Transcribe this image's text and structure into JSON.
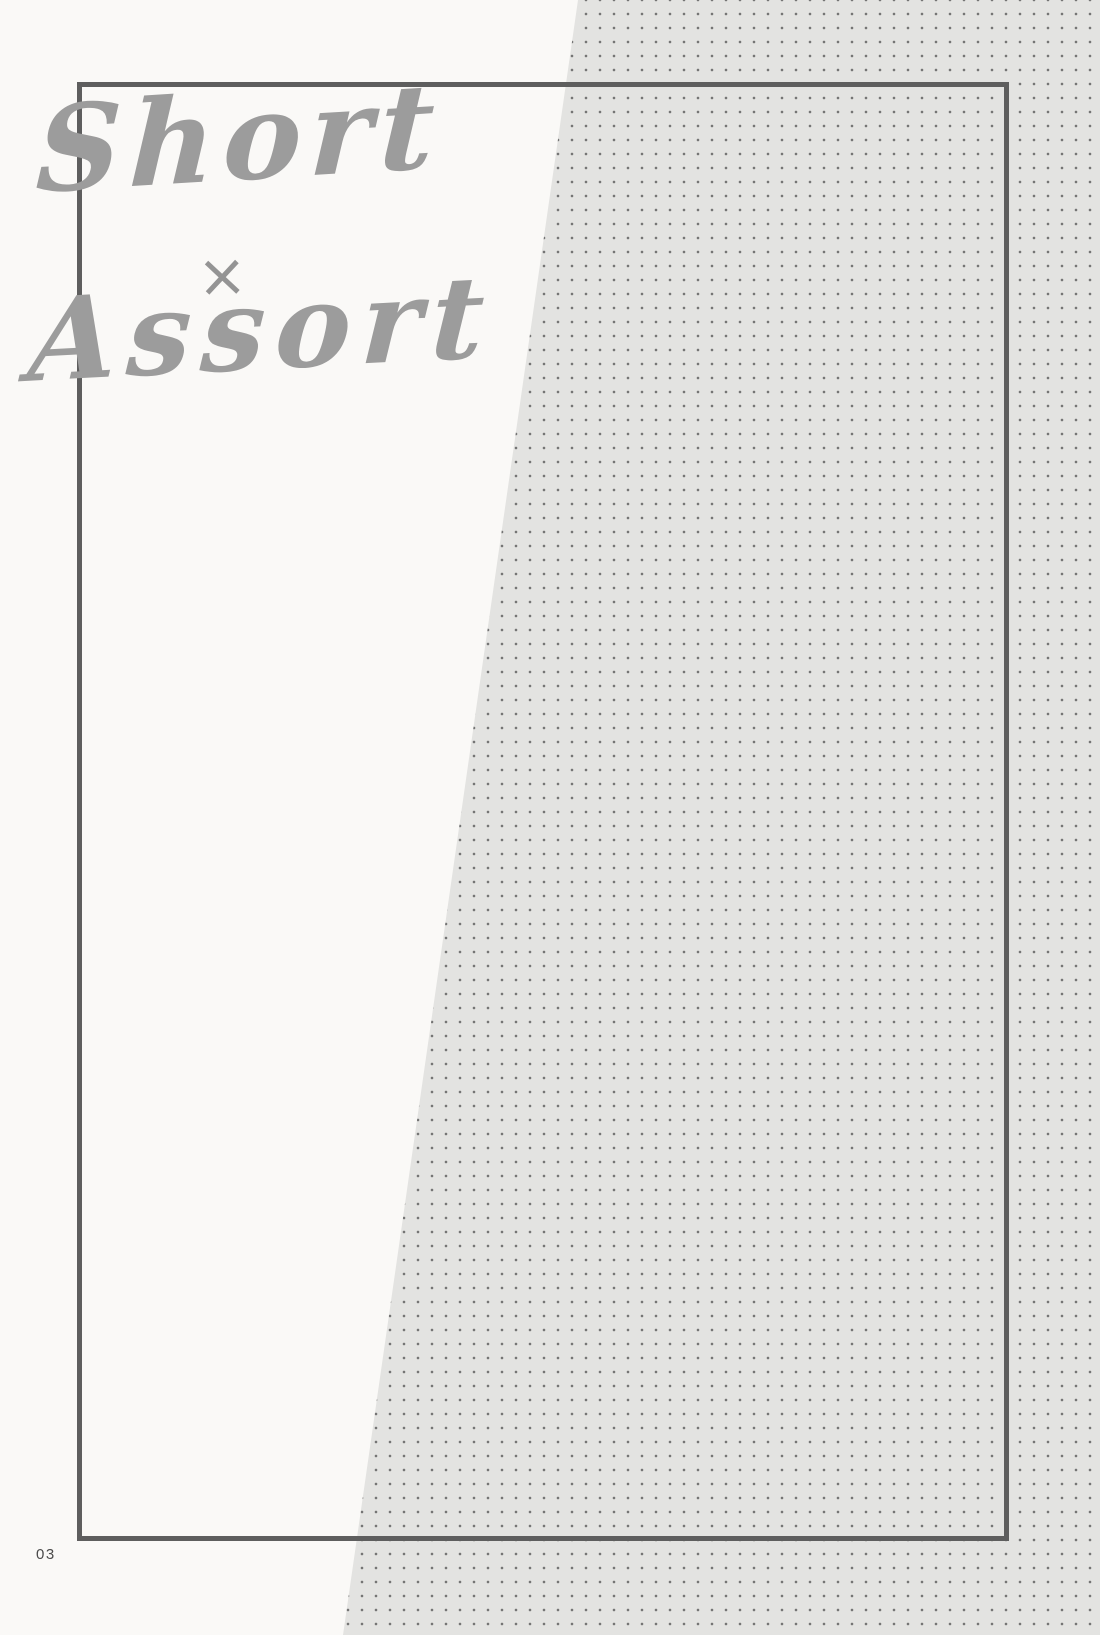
{
  "document": {
    "title": {
      "line1": "Short",
      "separator": "×",
      "line2": "Assort"
    },
    "page_number": "03",
    "colors": {
      "page_background": "#faf9f7",
      "dot_panel_background": "#e3e3e1",
      "dot_color": "#757575",
      "frame_border": "#5e5e5e",
      "title_text": "#9c9c9c",
      "page_number_text": "#4b4b4b"
    }
  }
}
